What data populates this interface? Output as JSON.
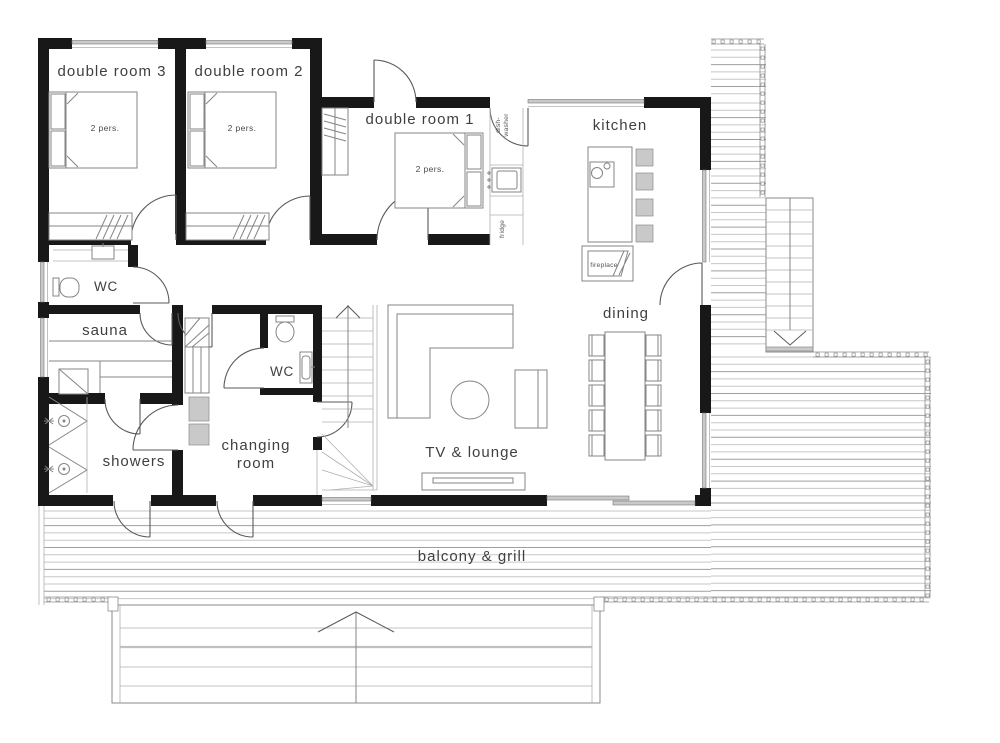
{
  "type": "floor-plan",
  "rooms": {
    "double_room_3": {
      "name": "double room 3",
      "capacity": "2 pers."
    },
    "double_room_2": {
      "name": "double room 2",
      "capacity": "2 pers."
    },
    "double_room_1": {
      "name": "double room 1",
      "capacity": "2 pers."
    },
    "kitchen": {
      "name": "kitchen"
    },
    "dining": {
      "name": "dining"
    },
    "wc_main": {
      "name": "WC"
    },
    "sauna": {
      "name": "sauna"
    },
    "wc_small": {
      "name": "WC"
    },
    "changing_room": {
      "name_line1": "changing",
      "name_line2": "room"
    },
    "showers": {
      "name": "showers"
    },
    "tv_lounge": {
      "name": "TV & lounge"
    },
    "balcony": {
      "name": "balcony & grill"
    }
  },
  "appliances": {
    "dishwasher_line1": "dish-",
    "dishwasher_line2": "washer",
    "fridge": "fridge",
    "fireplace": "fireplace"
  },
  "colors": {
    "walls": "#181818",
    "furniture_lines": "#858585",
    "deck_board_light": "#c7c7c7",
    "deck_board_dark": "#9f9f9f",
    "window_fill": "#c9c9c9",
    "label_text": "#3f3f3f"
  }
}
